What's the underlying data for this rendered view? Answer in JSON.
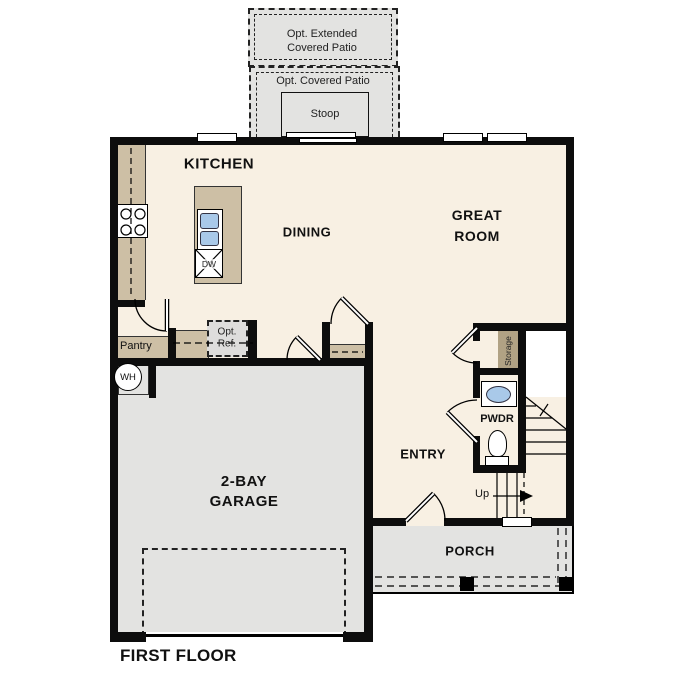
{
  "plan": {
    "title": "FIRST FLOOR",
    "rooms": {
      "kitchen": "KITCHEN",
      "dining": "DINING",
      "great_room_line1": "GREAT",
      "great_room_line2": "ROOM",
      "garage_line1": "2-BAY",
      "garage_line2": "GARAGE",
      "entry": "ENTRY",
      "powder": "PWDR",
      "porch": "PORCH",
      "pantry": "Pantry",
      "storage": "Storage"
    },
    "outdoor": {
      "ext_patio_line1": "Opt. Extended",
      "ext_patio_line2": "Covered Patio",
      "covered_patio": "Opt. Covered Patio",
      "stoop": "Stoop"
    },
    "fixtures": {
      "opt_ref_line1": "Opt.",
      "opt_ref_line2": "Ref.",
      "dishwasher": "DW",
      "water_heater": "WH",
      "stairs_up": "Up"
    },
    "colors": {
      "floor": "#f8f0e3",
      "garage": "#e3e3e1",
      "counter": "#cdbfa5",
      "shelf": "#b1a284",
      "sink": "#a9c9e9",
      "wall": "#0d0d0d"
    }
  }
}
